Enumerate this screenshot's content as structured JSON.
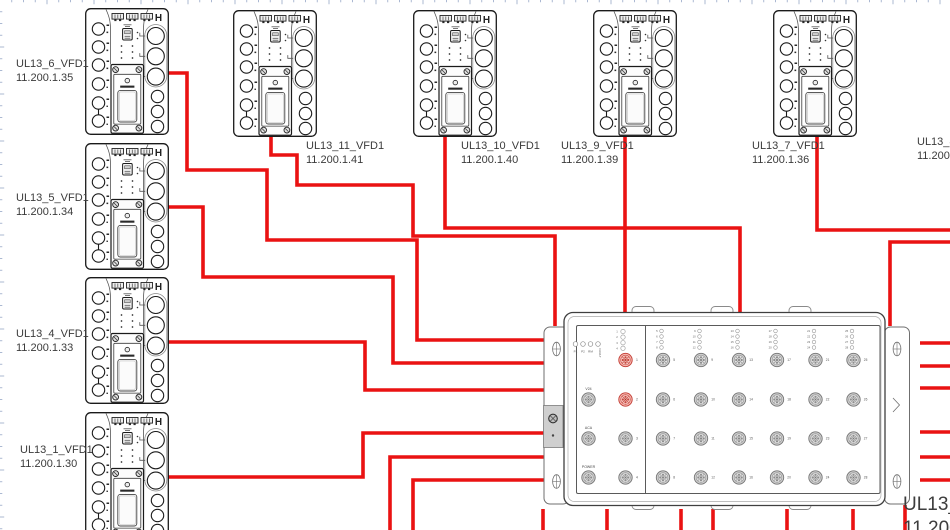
{
  "diagram_type": "network-wiring-diagram",
  "colors": {
    "cable": "#ea1212",
    "tick": "#a2b1cd",
    "label_text": "#3b3b3b",
    "port_red_fill": "#f6b6af",
    "port_red_stroke": "#c23b32",
    "port_gray_fill": "#cecece",
    "port_gray_stroke": "#757575"
  },
  "devices": [
    {
      "name": "UL13_6_VFD1",
      "ip": "11.200.1.35",
      "x": 85,
      "y": 8,
      "label_x": 16,
      "label_y": 58
    },
    {
      "name": "UL13_5_VFD1",
      "ip": "11.200.1.34",
      "x": 85,
      "y": 143,
      "label_x": 16,
      "label_y": 192
    },
    {
      "name": "UL13_4_VFD1",
      "ip": "11.200.1.33",
      "x": 85,
      "y": 277,
      "label_x": 16,
      "label_y": 328
    },
    {
      "name": "UL13_1_VFD1",
      "ip": "11.200.1.30",
      "x": 85,
      "y": 412,
      "label_x": 20,
      "label_y": 444
    },
    {
      "name": "UL13_11_VFD1",
      "ip": "11.200.1.41",
      "x": 233,
      "y": 10,
      "label_x": 306,
      "label_y": 140
    },
    {
      "name": "UL13_10_VFD1",
      "ip": "11.200.1.40",
      "x": 413,
      "y": 10,
      "label_x": 461,
      "label_y": 140
    },
    {
      "name": "UL13_9_VFD1",
      "ip": "11.200.1.39",
      "x": 593,
      "y": 10,
      "label_x": 561,
      "label_y": 140
    },
    {
      "name": "UL13_7_VFD1",
      "ip": "11.200.1.36",
      "x": 773,
      "y": 10,
      "label_x": 752,
      "label_y": 140
    },
    {
      "name": "UL13_8_VFD1",
      "ip": "11.200.1.",
      "x": null,
      "y": null,
      "label_x": 917,
      "label_y": 136
    }
  ],
  "switch": {
    "name_line1": "UL13_",
    "name_line2": "11.200.1.",
    "indicator_labels": [
      "P1",
      "P2",
      "RM",
      "FAULT"
    ],
    "status_leds": [
      "1",
      "2",
      "3",
      "4"
    ],
    "aux_ports": [
      "V24",
      "ACA",
      "POWER"
    ],
    "left_ports": [
      {
        "num": "1",
        "active": true
      },
      {
        "num": "2",
        "active": true
      },
      {
        "num": "3",
        "active": false
      },
      {
        "num": "4",
        "active": false
      }
    ],
    "port_columns": [
      [
        "5",
        "6",
        "7",
        "8"
      ],
      [
        "9",
        "10",
        "11",
        "12"
      ],
      [
        "13",
        "14",
        "15",
        "16"
      ],
      [
        "17",
        "18",
        "19",
        "20"
      ],
      [
        "21",
        "22",
        "23",
        "24"
      ],
      [
        "25",
        "26",
        "27",
        "28"
      ]
    ]
  },
  "cables": [
    {
      "name": "UL13_6",
      "points": [
        [
          168,
          73
        ],
        [
          187,
          73
        ],
        [
          187,
          170
        ],
        [
          267,
          170
        ],
        [
          267,
          240
        ],
        [
          417,
          240
        ],
        [
          417,
          340
        ],
        [
          546,
          340
        ]
      ]
    },
    {
      "name": "UL13_5",
      "points": [
        [
          168,
          207
        ],
        [
          203,
          207
        ],
        [
          203,
          277
        ],
        [
          393,
          277
        ],
        [
          393,
          363
        ],
        [
          546,
          363
        ]
      ]
    },
    {
      "name": "UL13_4",
      "points": [
        [
          168,
          342
        ],
        [
          365,
          342
        ],
        [
          365,
          390
        ],
        [
          546,
          390
        ]
      ]
    },
    {
      "name": "UL13_1",
      "points": [
        [
          168,
          477
        ],
        [
          363,
          477
        ],
        [
          363,
          433
        ],
        [
          546,
          433
        ]
      ]
    },
    {
      "name": "from-below-1",
      "points": [
        [
          390,
          533
        ],
        [
          390,
          457
        ],
        [
          546,
          457
        ]
      ]
    },
    {
      "name": "from-below-2",
      "points": [
        [
          413,
          533
        ],
        [
          413,
          480
        ],
        [
          546,
          480
        ]
      ]
    },
    {
      "name": "UL13_11",
      "points": [
        [
          271,
          137
        ],
        [
          271,
          155
        ],
        [
          297,
          155
        ],
        [
          297,
          185
        ],
        [
          413,
          185
        ],
        [
          413,
          236
        ],
        [
          555,
          236
        ],
        [
          555,
          326
        ]
      ]
    },
    {
      "name": "UL13_10",
      "points": [
        [
          445,
          137
        ],
        [
          445,
          228
        ],
        [
          740,
          228
        ],
        [
          740,
          312
        ]
      ]
    },
    {
      "name": "UL13_9",
      "points": [
        [
          625,
          137
        ],
        [
          625,
          312
        ]
      ]
    },
    {
      "name": "UL13_7",
      "points": [
        [
          817,
          137
        ],
        [
          817,
          230
        ],
        [
          950,
          230
        ]
      ]
    },
    {
      "name": "UL13_8",
      "points": [
        [
          950,
          242
        ],
        [
          890,
          242
        ],
        [
          890,
          326
        ]
      ]
    },
    {
      "name": "stub-right-1",
      "points": [
        [
          920,
          343
        ],
        [
          950,
          343
        ]
      ]
    },
    {
      "name": "stub-right-2",
      "points": [
        [
          920,
          366
        ],
        [
          950,
          366
        ]
      ]
    },
    {
      "name": "stub-right-3",
      "points": [
        [
          920,
          388
        ],
        [
          950,
          388
        ]
      ]
    },
    {
      "name": "stub-right-4",
      "points": [
        [
          920,
          432
        ],
        [
          950,
          432
        ]
      ]
    },
    {
      "name": "stub-right-5",
      "points": [
        [
          920,
          457
        ],
        [
          950,
          457
        ]
      ]
    },
    {
      "name": "stub-right-6",
      "points": [
        [
          920,
          480
        ],
        [
          950,
          480
        ]
      ]
    },
    {
      "name": "stub-bottom-1",
      "points": [
        [
          543,
          509
        ],
        [
          543,
          533
        ]
      ]
    },
    {
      "name": "stub-bottom-2",
      "points": [
        [
          607,
          509
        ],
        [
          607,
          533
        ]
      ]
    },
    {
      "name": "stub-bottom-3",
      "points": [
        [
          681,
          509
        ],
        [
          681,
          533
        ]
      ]
    },
    {
      "name": "stub-bottom-4",
      "points": [
        [
          713,
          509
        ],
        [
          713,
          533
        ]
      ]
    },
    {
      "name": "stub-bottom-5",
      "points": [
        [
          787,
          509
        ],
        [
          787,
          533
        ]
      ]
    },
    {
      "name": "stub-bottom-6",
      "points": [
        [
          853,
          509
        ],
        [
          853,
          533
        ]
      ]
    },
    {
      "name": "stub-bottom-7",
      "points": [
        [
          905,
          505
        ],
        [
          905,
          533
        ]
      ]
    }
  ],
  "switch_geometry": {
    "port_rows_y": [
      360,
      399.5,
      438.5,
      477.5
    ],
    "port_col_x": [
      663,
      701,
      739,
      777,
      815.5,
      853.5
    ],
    "left_port_x": 625.5,
    "aux_port_x": 588.5
  }
}
